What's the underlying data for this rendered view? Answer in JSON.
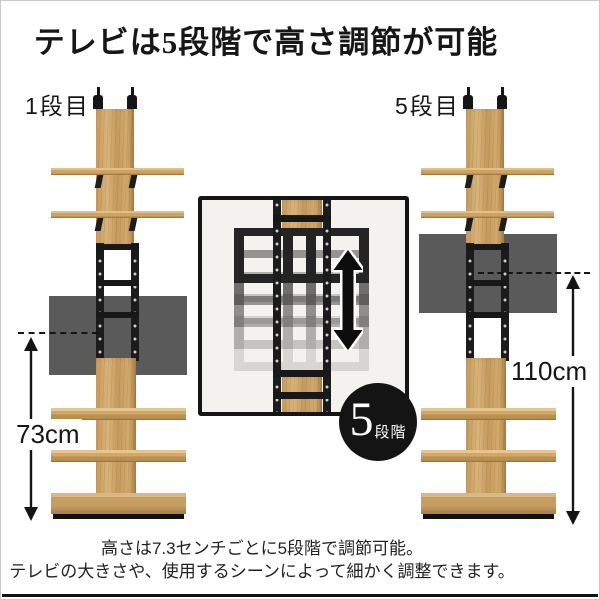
{
  "title": "テレビは5段階で高さ調節が可能",
  "left_unit": {
    "stage_label": "1段目",
    "height_label": "73cm"
  },
  "right_unit": {
    "stage_label": "5段目",
    "height_label": "110cm"
  },
  "badge": {
    "number": "5",
    "unit": "段階"
  },
  "caption": {
    "line1": "高さは7.3センチごとに5段階で調節可能。",
    "line2": "テレビの大きさや、使用するシーンによって細かく調整できます。"
  },
  "icons": {
    "inset_arrow": "up-down-arrow",
    "left_arrow": "double-headed-vertical-arrow",
    "right_arrow": "double-headed-vertical-arrow"
  },
  "colors": {
    "wood": "#cda263",
    "wood_dark_edge": "#96703c",
    "metal": "#1b1b1b",
    "tv_screen": "#5a5a5a",
    "badge_bg": "#141414",
    "inset_bg": "#f4f2ee",
    "text": "#1b1b1b",
    "bottom_rule": "#121212"
  }
}
